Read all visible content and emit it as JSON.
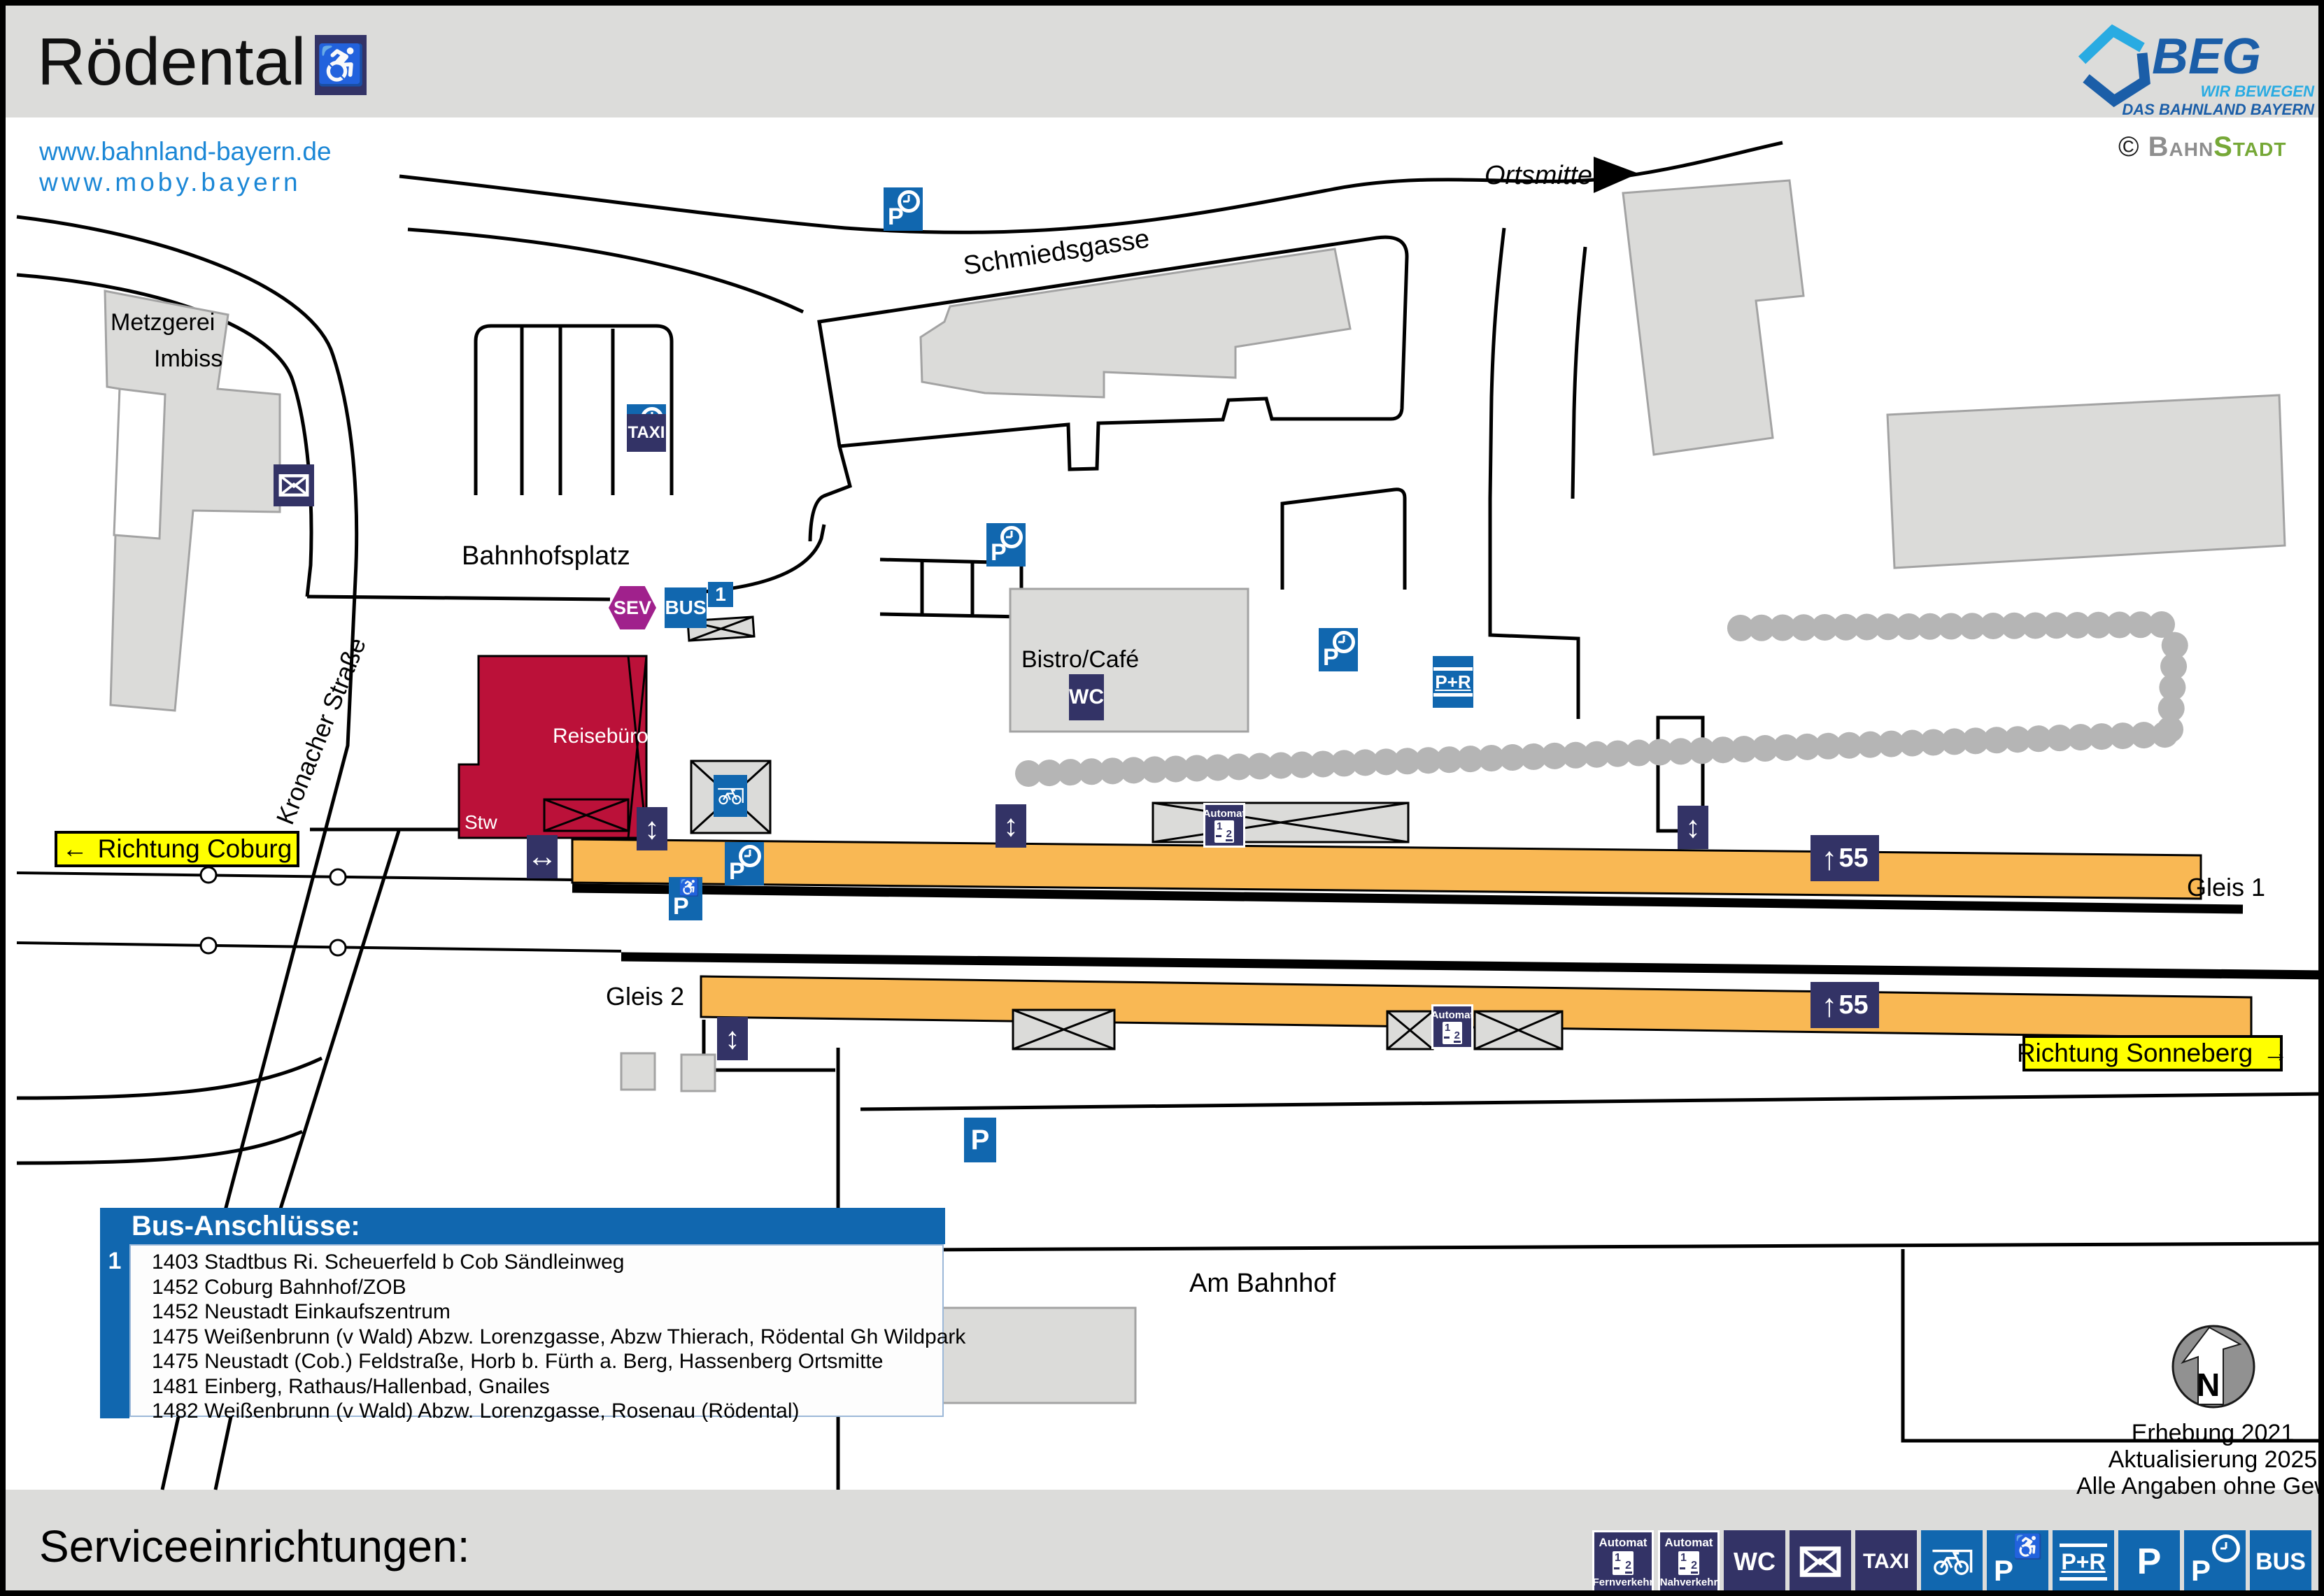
{
  "header": {
    "title": "Rödental"
  },
  "links": {
    "line1": "www.bahnland-bayern.de",
    "line2": "www.moby.bayern"
  },
  "logo": {
    "name": "BEG",
    "tagline1": "WIR BEWEGEN",
    "tagline2": "DAS BAHNLAND BAYERN",
    "credit_symbol": "©",
    "credit_part1": "Bahn",
    "credit_part2": "Stadt"
  },
  "colors": {
    "navy": "#333366",
    "blue": "#1167af",
    "purple": "#a0218c",
    "platform_orange": "#f9b854",
    "building_red": "#bb1139",
    "sign_yellow": "#ffff00",
    "link_blue": "#1b87d6",
    "building_gray": "#dbdbd9",
    "hedge_gray": "#b5b5b5"
  },
  "map": {
    "streets": {
      "kronacher": "Kronacher Straße",
      "schmiedsgasse": "Schmiedsgasse",
      "bahnhofsplatz": "Bahnhofsplatz",
      "am_bahnhof": "Am Bahnhof",
      "ortsmitte": "Ortsmitte"
    },
    "places": {
      "metzgerei": "Metzgerei",
      "imbiss": "Imbiss",
      "bistro": "Bistro/Café",
      "reisebuero": "Reisebüro",
      "stw": "Stw"
    },
    "platforms": {
      "gleis1": "Gleis 1",
      "gleis2": "Gleis 2",
      "height_marker": "55"
    },
    "directions": {
      "coburg": "Richtung Coburg",
      "sonneberg": "Richtung Sonneberg"
    }
  },
  "icons": {
    "p": "P",
    "p_plus_r": "P+R",
    "wc": "WC",
    "taxi": "TAXI",
    "bus": "BUS",
    "sev": "SEV",
    "automat": "Automat",
    "fernverkehr": "Fernverkehr",
    "nahverkehr": "Nahverkehr",
    "wheelchair": "♿",
    "automat_1": "1",
    "automat_2": "2",
    "arrow_up": "↑",
    "arrow_updown": "↕",
    "arrow_leftright": "↔",
    "arrow_left": "←",
    "arrow_right": "→"
  },
  "bus_box": {
    "title": "Bus-Anschlüsse:",
    "stop_number": "1",
    "routes": [
      "1403 Stadtbus Ri. Scheuerfeld b Cob Sändleinweg",
      "1452 Coburg Bahnhof/ZOB",
      "1452 Neustadt Einkaufszentrum",
      "1475 Weißenbrunn (v Wald) Abzw. Lorenzgasse, Abzw Thierach, Rödental Gh Wildpark",
      "1475 Neustadt (Cob.) Feldstraße, Horb b. Fürth a. Berg, Hassenberg Ortsmitte",
      "1481 Einberg, Rathaus/Hallenbad, Gnailes",
      "1482 Weißenbrunn (v Wald) Abzw. Lorenzgasse, Rosenau (Rödental)"
    ]
  },
  "footer": {
    "title": "Serviceeinrichtungen:"
  },
  "notes": {
    "line1": "Erhebung 2021",
    "line2": "Aktualisierung 2025",
    "line3": "Alle Angaben ohne Gewähr!",
    "compass_n": "N"
  }
}
